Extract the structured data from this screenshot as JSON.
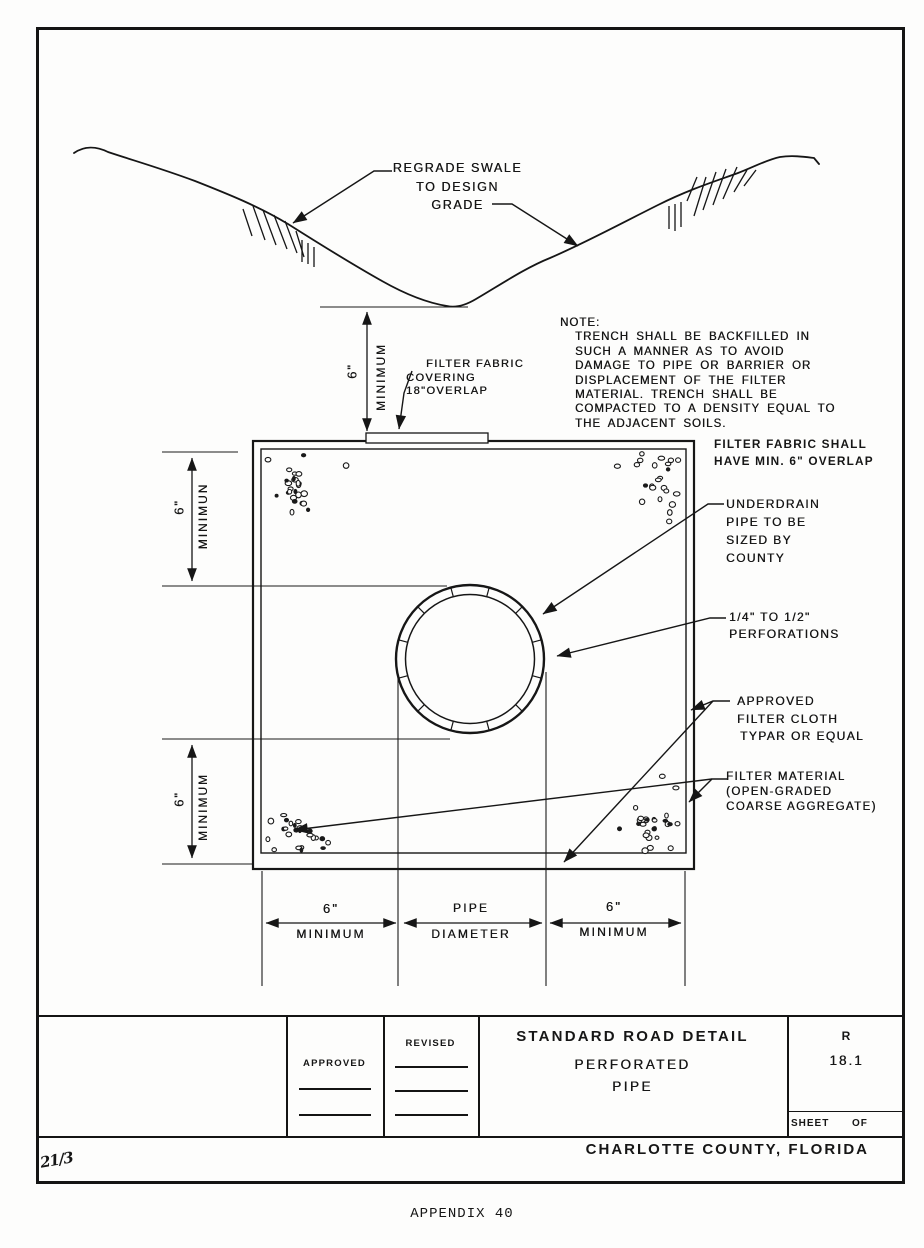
{
  "swale": {
    "label": [
      "REGRADE SWALE",
      "TO DESIGN",
      "GRADE"
    ]
  },
  "note": {
    "heading": "NOTE:",
    "lines": [
      "TRENCH SHALL BE BACKFILLED IN",
      "SUCH A MANNER AS TO AVOID",
      "DAMAGE TO PIPE OR BARRIER OR",
      "DISPLACEMENT OF THE FILTER",
      "MATERIAL. TRENCH SHALL BE",
      "COMPACTED TO A DENSITY EQUAL TO",
      "THE ADJACENT SOILS."
    ]
  },
  "callouts": {
    "fabric_covering": [
      "FILTER FABRIC",
      "COVERING",
      "18\"OVERLAP"
    ],
    "fabric_overlap": [
      "FILTER FABRIC SHALL",
      "HAVE MIN. 6\" OVERLAP"
    ],
    "underdrain": [
      "UNDERDRAIN",
      "PIPE TO BE",
      "SIZED BY",
      "COUNTY"
    ],
    "perforations": [
      "1/4\" TO 1/2\"",
      "PERFORATIONS"
    ],
    "filter_cloth": [
      "APPROVED",
      "FILTER CLOTH",
      "TYPAR OR EQUAL"
    ],
    "filter_material": [
      "FILTER MATERIAL",
      "(OPEN-GRADED",
      "COARSE AGGREGATE)"
    ]
  },
  "dimensions": {
    "trench_cover": {
      "value": "6\"",
      "word": "MINIMUM"
    },
    "upper_left": {
      "value": "6\"",
      "word": "MINIMUN"
    },
    "lower_left": {
      "value": "6\"",
      "word": "MINIMUM"
    },
    "bottom_left": {
      "value": "6\"",
      "word": "MINIMUM"
    },
    "bottom_center": {
      "value": "PIPE",
      "word": "DIAMETER"
    },
    "bottom_right": {
      "value": "6\"",
      "word": "MINIMUM"
    }
  },
  "title_block": {
    "approved_label": "APPROVED",
    "revised_label": "REVISED",
    "title": "STANDARD ROAD DETAIL",
    "subtitle": [
      "PERFORATED",
      "PIPE"
    ],
    "detail_letter": "R",
    "detail_number": "18.1",
    "sheet_label": "SHEET",
    "of_label": "OF",
    "county": "CHARLOTTE COUNTY, FLORIDA"
  },
  "page": {
    "appendix": "APPENDIX 40",
    "handwritten_mark": "21/3"
  },
  "colors": {
    "ink": "#161616",
    "paper": "#fdfdfc"
  }
}
